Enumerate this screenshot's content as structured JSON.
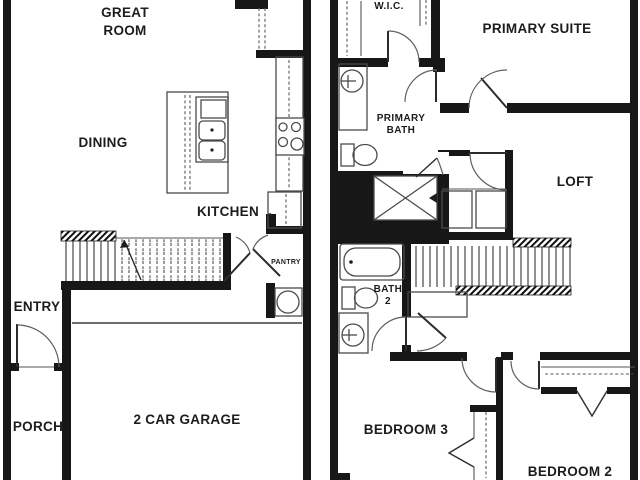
{
  "document": {
    "type": "two-story residential floor plan",
    "colors": {
      "background": "#ffffff",
      "wall_ink": "#171717",
      "line_ink": "#4a4a4a",
      "text_ink": "#1c1c1c"
    }
  },
  "floor1": {
    "great_room_l1": "GREAT",
    "great_room_l2": "ROOM",
    "dining": "DINING",
    "kitchen": "KITCHEN",
    "pantry": "PANTRY",
    "entry": "ENTRY",
    "porch": "PORCH",
    "garage": "2 CAR GARAGE"
  },
  "floor2": {
    "wic": "W.I.C.",
    "primary_suite": "PRIMARY SUITE",
    "primary_bath_l1": "PRIMARY",
    "primary_bath_l2": "BATH",
    "loft": "LOFT",
    "bath2_l1": "BATH",
    "bath2_l2": "2",
    "bedroom3": "BEDROOM 3",
    "bedroom2": "BEDROOM 2"
  }
}
